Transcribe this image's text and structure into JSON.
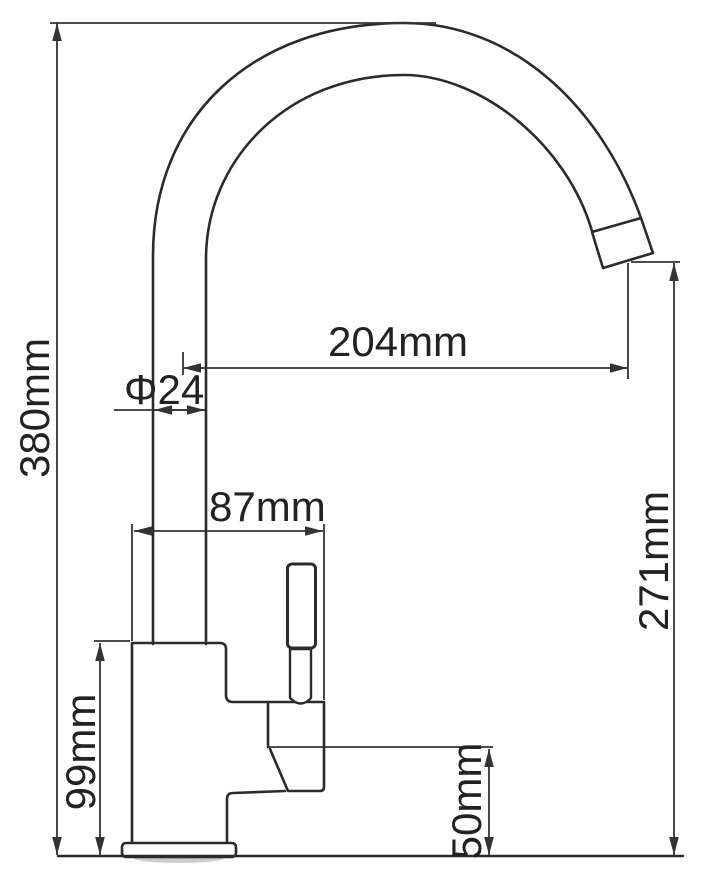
{
  "drawing": {
    "title": "Kitchen faucet dimensional drawing (side view)",
    "background_color": "#ffffff",
    "outline_color": "#2b2b2b",
    "dimension_color": "#333333",
    "text_color": "#222222",
    "unit": "mm"
  },
  "dimensions": {
    "overall_height": {
      "label": "380mm",
      "value_mm": 380,
      "orientation": "vertical-rotated"
    },
    "spout_reach": {
      "label": "204mm",
      "value_mm": 204,
      "orientation": "horizontal"
    },
    "pipe_diameter": {
      "label": "Φ24",
      "value_mm": 24,
      "orientation": "horizontal"
    },
    "body_depth": {
      "label": "87mm",
      "value_mm": 87,
      "orientation": "horizontal"
    },
    "outlet_height": {
      "label": "271mm",
      "value_mm": 271,
      "orientation": "vertical-rotated"
    },
    "body_height": {
      "label": "99mm",
      "value_mm": 99,
      "orientation": "vertical-rotated"
    },
    "outlet_port_height": {
      "label": "50mm",
      "value_mm": 50,
      "orientation": "vertical-rotated"
    }
  }
}
